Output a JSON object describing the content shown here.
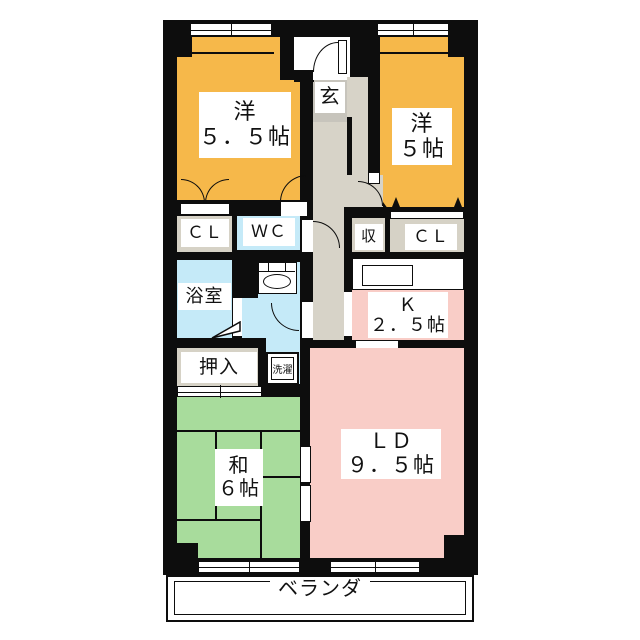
{
  "plan_title": "apartment-floor-plan",
  "colors": {
    "wall": "#0d0d0d",
    "western_room": "#F6B84A",
    "living_dining": "#F9CDC7",
    "kitchen": "#F9CDC7",
    "tatami_room": "#A8DC9C",
    "wet_area": "#C5EAF8",
    "closet": "#D6D2C6",
    "hallway": "#D7D3C8",
    "entry_floor": "#C7C4BC"
  },
  "rooms": {
    "western1": {
      "name": "洋",
      "size": "５．５帖"
    },
    "western2": {
      "name": "洋",
      "size": "５帖"
    },
    "entry": {
      "name": "玄"
    },
    "closet_left": {
      "name": "ＣＬ"
    },
    "toilet": {
      "name": "ＷＣ"
    },
    "storage": {
      "name": "収"
    },
    "closet_right": {
      "name": "ＣＬ"
    },
    "bathroom": {
      "name": "浴室"
    },
    "kitchen": {
      "name": "Ｋ",
      "size": "２．５帖"
    },
    "oshiire": {
      "name": "押入"
    },
    "laundry": {
      "name": "洗濯"
    },
    "tatami": {
      "name": "和",
      "size": "６帖"
    },
    "living_dining": {
      "name": "ＬＤ",
      "size": "９．５帖"
    },
    "balcony": {
      "name": "ベランダ"
    }
  }
}
